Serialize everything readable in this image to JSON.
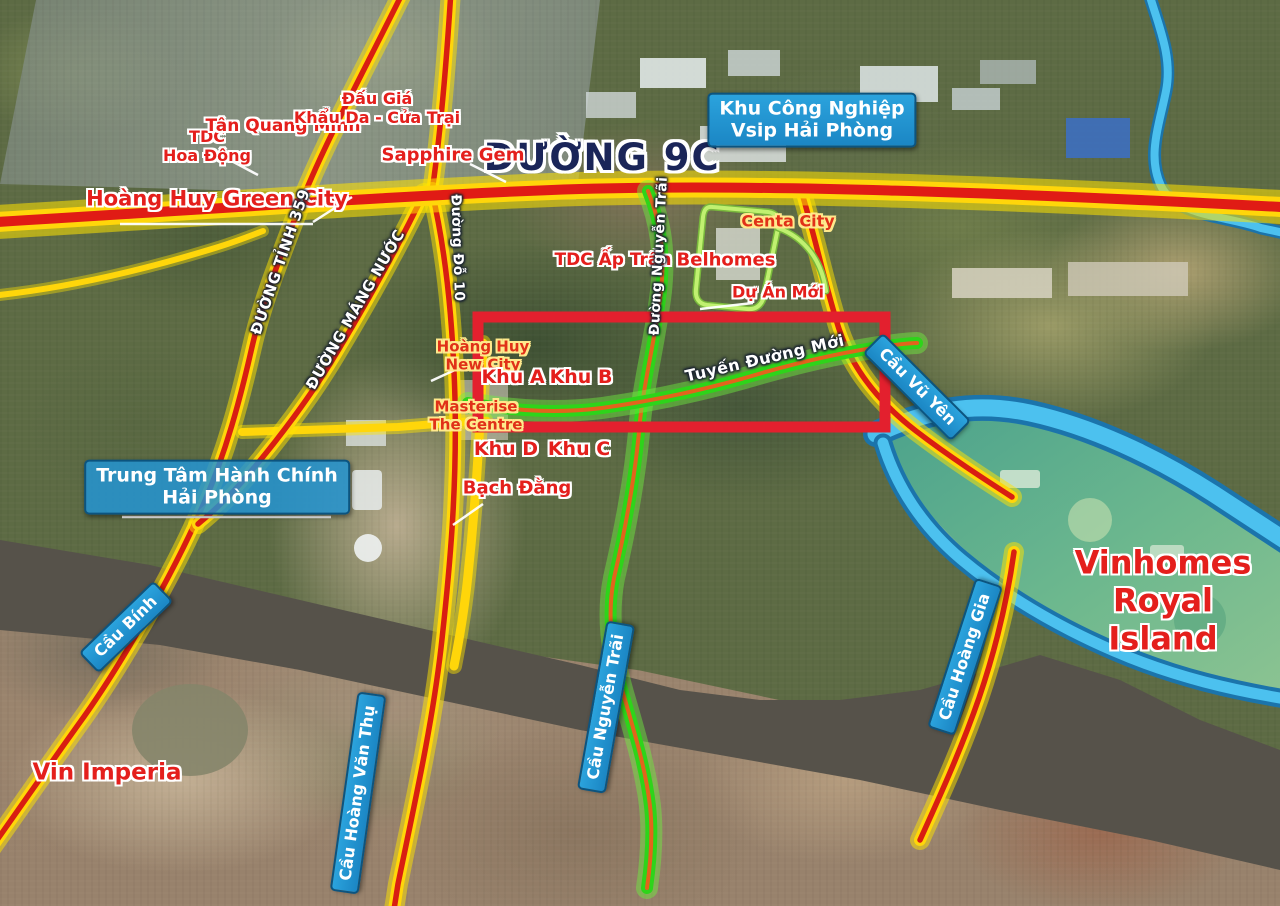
{
  "title": "ĐƯỜNG 9C",
  "industrial_zone": {
    "vsip": "Khu Công Nghiệp\nVsip Hải Phòng"
  },
  "admin": {
    "trung_tam": "Trung Tâm Hành Chính\nHải Phòng"
  },
  "roads": {
    "d359": "ĐƯỜNG TỈNH 359",
    "mang_nuoc": "ĐƯỜNG MÁNG NƯỚC",
    "do10": "Đường Đỗ 10",
    "nguyen_trai": "Đường Nguyễn Trãi",
    "tuyen_duong_moi": "Tuyến Đường Mới"
  },
  "bridges": {
    "vu_yen": "Cầu Vũ Yên",
    "hoang_gia": "Cầu Hoàng Gia",
    "nguyen_trai": "Cầu Nguyễn Trãi",
    "binh": "Cầu Bính",
    "hoang_van_thu": "Cầu Hoàng Văn Thụ"
  },
  "projects": {
    "tdc_hoa_dong": "TDC\nHoa Động",
    "tan_quang_minh": "Tân Quang Minh",
    "dau_gia": "Đấu Giá\nKhẩu Da - Cửa Trại",
    "sapphire_gem": "Sapphire Gem",
    "hoang_huy_green_city": "Hoàng Huy Green City",
    "tdc_ap_tran": "TDC Ấp Trần",
    "centa_city": "Centa City",
    "belhomes": "Belhomes",
    "du_an_moi": "Dự Án Mới",
    "hoang_huy_new_city": "Hoàng Huy\nNew City",
    "masterise": "Masterise\nThe Centre",
    "bach_dang": "Bạch Đằng",
    "vin_imperia": "Vin Imperia",
    "vinhomes_royal_island": "Vinhomes\nRoyal Island"
  },
  "zones": {
    "a": "Khu A",
    "b": "Khu B",
    "c": "Khu C",
    "d": "Khu D"
  },
  "colors": {
    "road_casing": "#ffd60a",
    "road_center": "#d81e12",
    "new_road_green": "#2ed41a",
    "water_blue": "#4cc1ef",
    "highlight_box": "#e3202e",
    "label_blue": "#1f97d4"
  }
}
